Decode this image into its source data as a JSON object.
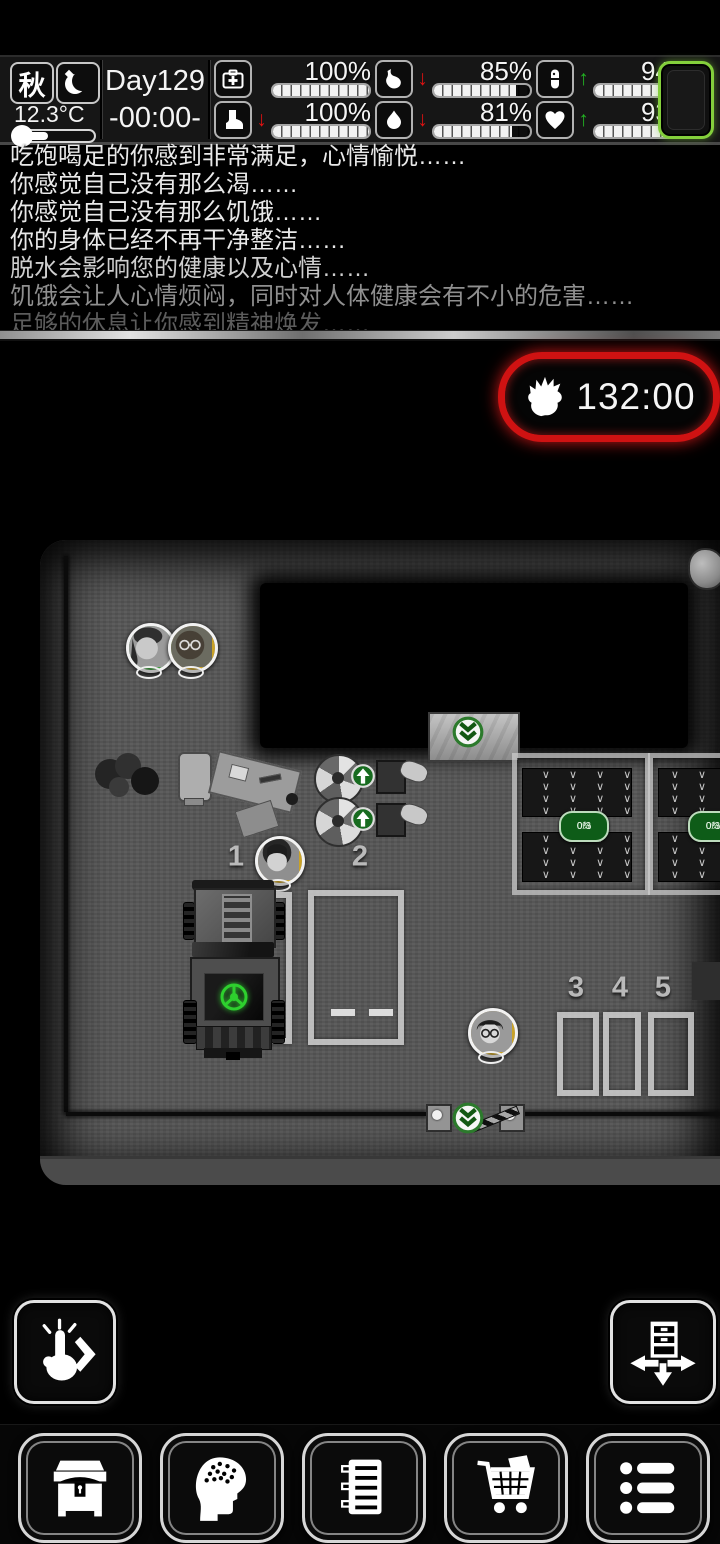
{
  "status_bar": {
    "season_label": "秋",
    "moon_icon": "crescent-moon-icon",
    "temperature": "12.3°C",
    "day_label": "Day129",
    "time_label": "-00:00-",
    "stats": [
      {
        "icon": "medkit-icon",
        "value": "100%",
        "arrow": "",
        "fill": 1
      },
      {
        "icon": "boot-icon",
        "value": "100%",
        "arrow": "↓",
        "fill": 1
      },
      {
        "icon": "stomach-icon",
        "value": "85%",
        "arrow": "↓",
        "fill": 0.85
      },
      {
        "icon": "water-drop-icon",
        "value": "81%",
        "arrow": "↓",
        "fill": 0.81
      },
      {
        "icon": "pill-icon",
        "value": "94%",
        "arrow": "↑",
        "fill": 0.94
      },
      {
        "icon": "heart-icon",
        "value": "93%",
        "arrow": "↑",
        "fill": 0.93
      }
    ],
    "colors": {
      "trend_down": "#e01212",
      "trend_up": "#22b322",
      "battery_outline": "#84cf3c"
    }
  },
  "log": {
    "lines": [
      {
        "text": "吃饱喝足的你感到非常满足，心情愉悦……",
        "tone": "bright"
      },
      {
        "text": "你感觉自己没有那么渴……",
        "tone": "bright"
      },
      {
        "text": "你感觉自己没有那么饥饿……",
        "tone": "bright"
      },
      {
        "text": "你的身体已经不再干净整洁……",
        "tone": "bright"
      },
      {
        "text": "脱水会影响您的健康以及心情……",
        "tone": "medium"
      },
      {
        "text": "饥饿会让人心情烦闷，同时对人体健康会有不小的危害……",
        "tone": "dim"
      },
      {
        "text": "足够的休息让你感到精神焕发……",
        "tone": "faint"
      }
    ]
  },
  "timer": {
    "value": "132:00",
    "icon": "zombie-hand-icon",
    "border_color": "#cf1212"
  },
  "map": {
    "parking_spot_labels": [
      "1",
      "2",
      "3",
      "4",
      "5"
    ],
    "farm_plot_badges": [
      {
        "count": "0/3",
        "percent": "0%"
      },
      {
        "count": "0/3",
        "percent": "0%"
      }
    ],
    "avatars": [
      {
        "ring_color": "green",
        "portrait": "woman"
      },
      {
        "ring_color": "gold",
        "portrait": "bald-man-glasses"
      },
      {
        "ring_color": "gold",
        "portrait": "woman"
      },
      {
        "ring_color": "gold",
        "portrait": "young-man-glasses"
      }
    ],
    "marker_color": "#1e7c1e"
  },
  "controls": {
    "interact_button_icon": "tap-hand-chevron-icon",
    "furniture_button_icon": "move-drawer-icon"
  },
  "toolbar": {
    "buttons": [
      {
        "icon": "chest-icon"
      },
      {
        "icon": "brain-head-icon"
      },
      {
        "icon": "notebook-icon"
      },
      {
        "icon": "shopping-cart-icon"
      },
      {
        "icon": "bullet-list-icon"
      }
    ]
  }
}
